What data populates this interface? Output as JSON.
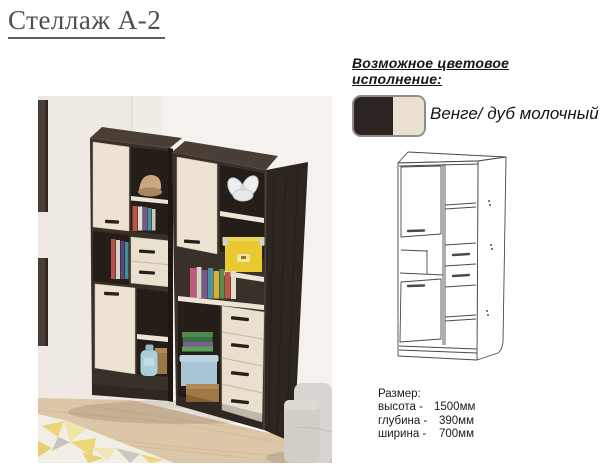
{
  "page": {
    "title": "Стеллаж А-2"
  },
  "color_section": {
    "heading": "Возможное цветовое исполнение:",
    "swatch_label": "Венге/ дуб молочный",
    "swatch_colors": {
      "wenge": "#2c2420",
      "milk_oak": "#ebe1d2"
    }
  },
  "size_section": {
    "heading": "Размер:",
    "rows": [
      {
        "label": "высота -",
        "value": "1500мм"
      },
      {
        "label": "глубина -",
        "value": "390мм"
      },
      {
        "label": "ширина -",
        "value": "700мм"
      }
    ]
  },
  "palette": {
    "wenge_front": "#3a302a",
    "wenge_top": "#4a3f36",
    "wenge_side": "#2d2520",
    "cavity": "#241d18",
    "oak_light": "#ece3d3",
    "wall_left": "#eeeae3",
    "wall_right": "#f5f2ee",
    "floor": "#dcc6a8",
    "yellow_box": "#e9c832",
    "sofa": "#d8d5d0"
  }
}
